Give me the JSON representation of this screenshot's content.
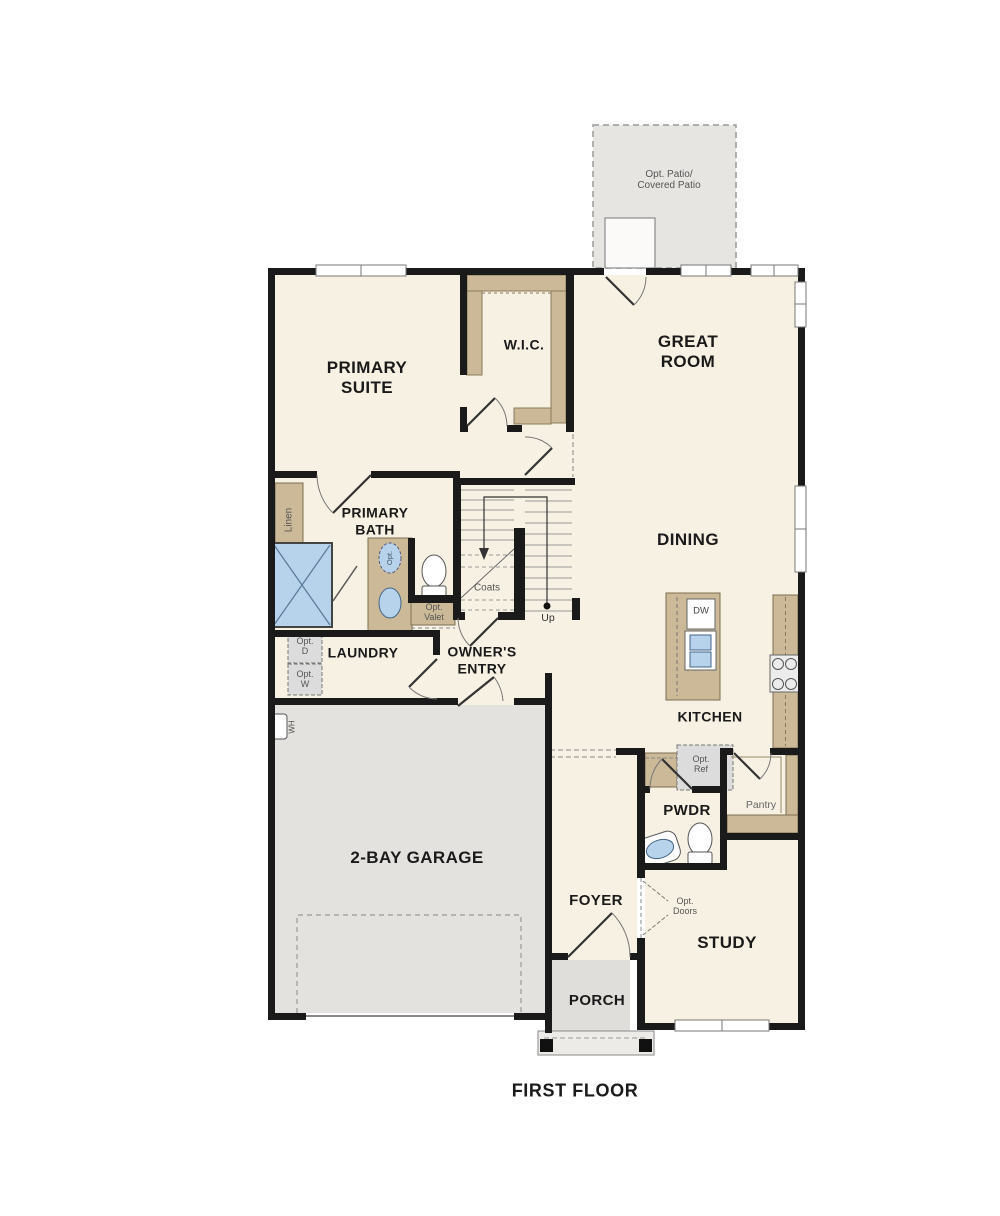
{
  "title": {
    "text": "FIRST FLOOR"
  },
  "rooms": {
    "patio": {
      "label": "Opt. Patio/\nCovered Patio"
    },
    "primary_suite": {
      "label": "PRIMARY\nSUITE"
    },
    "wic": {
      "label": "W.I.C."
    },
    "great_room": {
      "label": "GREAT\nROOM"
    },
    "dining": {
      "label": "DINING"
    },
    "primary_bath": {
      "label": "PRIMARY\nBATH"
    },
    "laundry": {
      "label": "LAUNDRY"
    },
    "owners_entry": {
      "label": "OWNER'S\nENTRY"
    },
    "garage": {
      "label": "2-BAY GARAGE"
    },
    "kitchen": {
      "label": "KITCHEN"
    },
    "pwdr": {
      "label": "PWDR"
    },
    "pantry": {
      "label": "Pantry"
    },
    "foyer": {
      "label": "FOYER"
    },
    "study": {
      "label": "STUDY"
    },
    "porch": {
      "label": "PORCH"
    }
  },
  "fixtures": {
    "linen": "Linen",
    "coats": "Coats",
    "up": "Up",
    "opt_valet": "Opt.\nValet",
    "opt_d": "Opt.\nD",
    "opt_w": "Opt.\nW",
    "wh": "WH",
    "dw": "DW",
    "opt_ref": "Opt.\nRef",
    "opt_doors": "Opt.\nDoors",
    "opt_sink": "Opt.",
    "opt_garage_door": ""
  },
  "colors": {
    "wall": "#1a1a1a",
    "floor": "#f7f1e3",
    "garage": "#e4e2df",
    "patio": "#e7e5e2",
    "porch": "#e0deda",
    "tan": "#cbb998",
    "blue": "#b7d3eb",
    "optbox": "#dcdcdc"
  }
}
